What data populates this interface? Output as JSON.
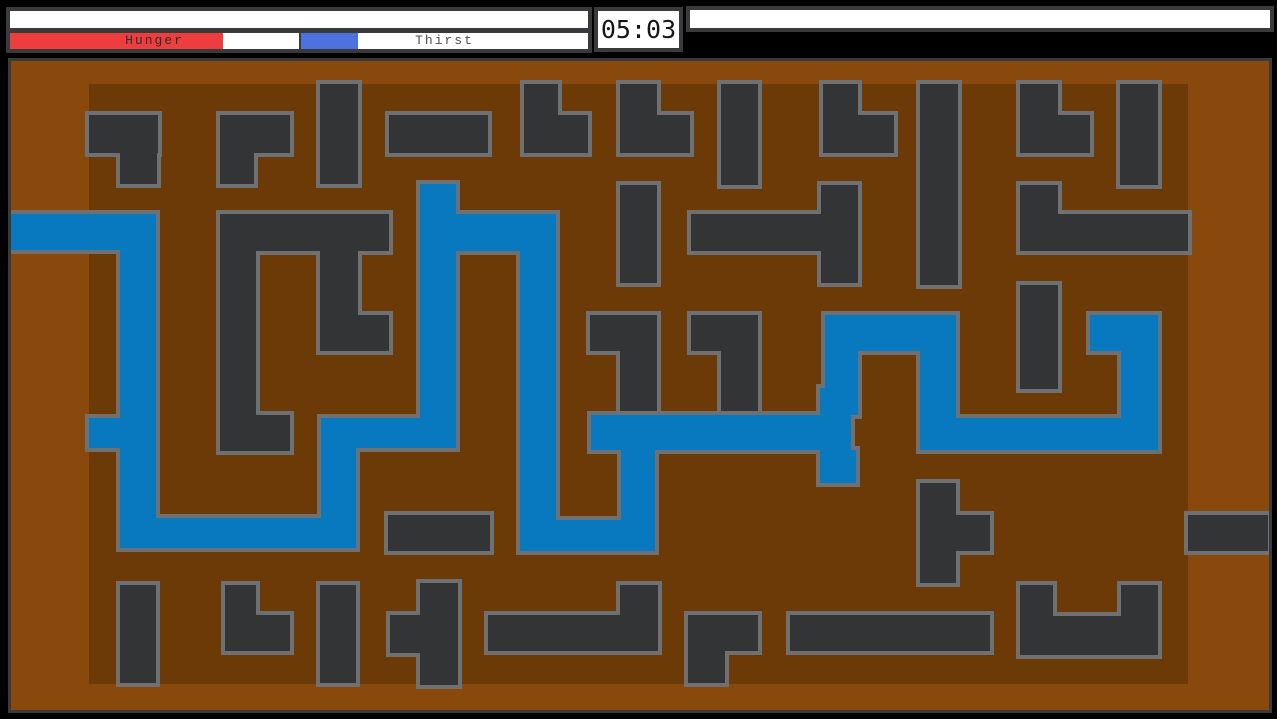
{
  "hud": {
    "top_status_bar": {
      "value": ""
    },
    "hunger": {
      "label": "Hunger",
      "fill_color": "#ee3d3d",
      "fill_px": 213,
      "total_px": 289
    },
    "thirst": {
      "label": "Thirst",
      "fill_color": "#4b72de",
      "fill_px": 57,
      "total_px": 287
    },
    "timer": {
      "value": "05:03"
    },
    "message_bar": {
      "value": ""
    }
  },
  "game": {
    "colors": {
      "margin_brown": "#8a490c",
      "floor_brown": "#6b3a06",
      "wall_fill": "#323436",
      "outline_gray": "#6e7072",
      "water_blue": "#0879bf"
    },
    "floor": [
      89,
      84,
      1099,
      600
    ],
    "walls": [
      [
        [
          89,
          115,
          69,
          38
        ],
        [
          120,
          153,
          37,
          31
        ]
      ],
      [
        [
          220,
          115,
          70,
          38
        ],
        [
          220,
          153,
          34,
          31
        ]
      ],
      [
        [
          320,
          84,
          38,
          100
        ]
      ],
      [
        [
          389,
          115,
          99,
          38
        ]
      ],
      [
        [
          524,
          84,
          34,
          69
        ],
        [
          558,
          115,
          30,
          38
        ]
      ],
      [
        [
          620,
          84,
          37,
          69
        ],
        [
          657,
          115,
          33,
          38
        ]
      ],
      [
        [
          721,
          84,
          37,
          101
        ]
      ],
      [
        [
          823,
          84,
          35,
          69
        ],
        [
          858,
          115,
          36,
          38
        ]
      ],
      [
        [
          920,
          84,
          38,
          201
        ]
      ],
      [
        [
          1020,
          84,
          38,
          69
        ],
        [
          1058,
          115,
          32,
          38
        ]
      ],
      [
        [
          1120,
          84,
          38,
          101
        ]
      ],
      [
        [
          220,
          214,
          169,
          37
        ],
        [
          220,
          251,
          36,
          200
        ],
        [
          256,
          415,
          34,
          36
        ],
        [
          320,
          251,
          38,
          100
        ],
        [
          358,
          315,
          31,
          36
        ]
      ],
      [
        [
          620,
          185,
          37,
          98
        ]
      ],
      [
        [
          691,
          214,
          130,
          37
        ],
        [
          821,
          185,
          37,
          98
        ]
      ],
      [
        [
          1020,
          185,
          38,
          66
        ],
        [
          1058,
          214,
          130,
          37
        ]
      ],
      [
        [
          1020,
          285,
          38,
          104
        ]
      ],
      [
        [
          590,
          315,
          67,
          36
        ],
        [
          620,
          351,
          37,
          61
        ]
      ],
      [
        [
          691,
          315,
          67,
          36
        ],
        [
          721,
          351,
          37,
          62
        ]
      ],
      [
        [
          388,
          515,
          102,
          36
        ]
      ],
      [
        [
          1188,
          515,
          80,
          36
        ]
      ],
      [
        [
          920,
          483,
          36,
          100
        ],
        [
          956,
          515,
          34,
          36
        ]
      ],
      [
        [
          120,
          585,
          36,
          98
        ]
      ],
      [
        [
          225,
          585,
          31,
          66
        ],
        [
          256,
          615,
          34,
          36
        ]
      ],
      [
        [
          320,
          585,
          36,
          98
        ]
      ],
      [
        [
          420,
          583,
          38,
          102
        ],
        [
          390,
          615,
          30,
          38
        ]
      ],
      [
        [
          488,
          615,
          170,
          36
        ],
        [
          620,
          585,
          38,
          30
        ]
      ],
      [
        [
          688,
          615,
          70,
          36
        ],
        [
          688,
          651,
          37,
          32
        ]
      ],
      [
        [
          790,
          615,
          200,
          36
        ]
      ],
      [
        [
          1020,
          585,
          33,
          70
        ],
        [
          1121,
          585,
          37,
          70
        ],
        [
          1020,
          616,
          138,
          39
        ]
      ]
    ],
    "water": [
      [
        11,
        214,
        145,
        36
      ],
      [
        120,
        250,
        36,
        298
      ],
      [
        89,
        418,
        31,
        30
      ],
      [
        120,
        518,
        236,
        30
      ],
      [
        321,
        418,
        35,
        100
      ],
      [
        321,
        418,
        135,
        30
      ],
      [
        420,
        184,
        36,
        264
      ],
      [
        420,
        214,
        136,
        37
      ],
      [
        520,
        251,
        36,
        300
      ],
      [
        520,
        520,
        135,
        31
      ],
      [
        621,
        450,
        34,
        101
      ],
      [
        591,
        415,
        260,
        35
      ],
      [
        820,
        388,
        31,
        30
      ],
      [
        820,
        450,
        36,
        33
      ],
      [
        825,
        315,
        131,
        36
      ],
      [
        825,
        351,
        33,
        64
      ],
      [
        920,
        351,
        36,
        99
      ],
      [
        921,
        418,
        200,
        32
      ],
      [
        1121,
        351,
        37,
        99
      ],
      [
        1090,
        315,
        68,
        36
      ]
    ]
  }
}
